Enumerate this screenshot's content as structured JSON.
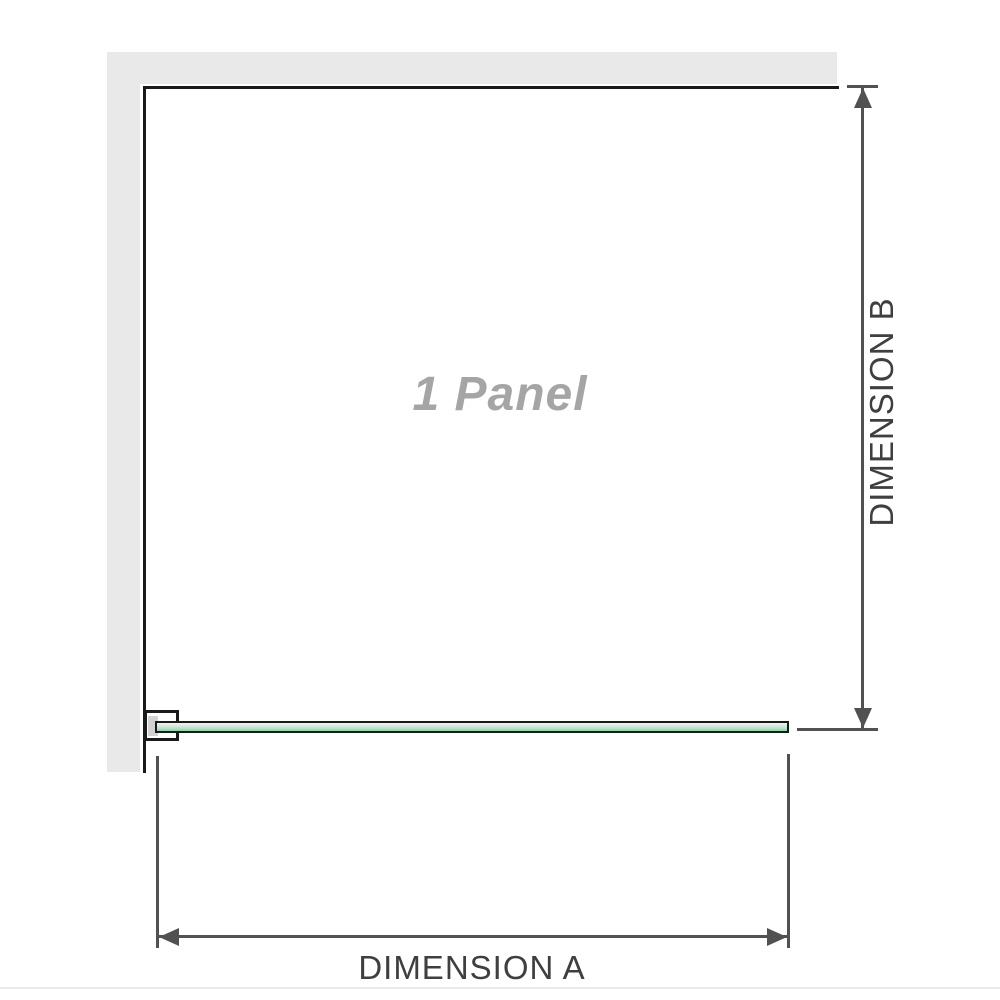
{
  "diagram": {
    "labels": {
      "panel": "1 Panel",
      "dimension_a": "DIMENSION A",
      "dimension_b": "DIMENSION B"
    },
    "colors": {
      "wall": "#e9e9e9",
      "outline": "#1a1a1a",
      "dim_line": "#515151",
      "label_text": "#3f3f3f",
      "panel_text": "#a5a5a5",
      "bracket_fill": "#d2d2d2",
      "glass_top": "#e8f5ec",
      "glass_mid": "#cdebd8",
      "glass_low": "#abdfbf",
      "glass_bottom": "#8fd2a6",
      "page_rule": "#e9e9e6"
    }
  }
}
